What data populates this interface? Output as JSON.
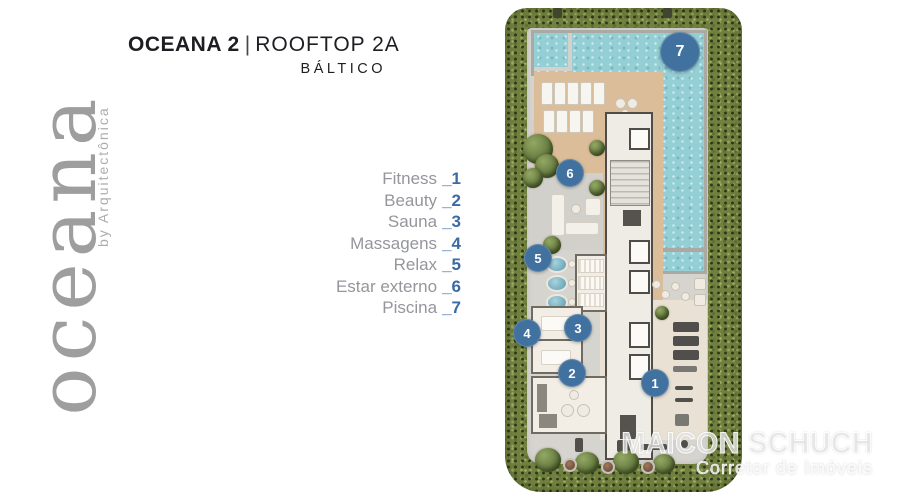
{
  "header": {
    "title_bold": "OCEANA 2",
    "title_divider": "|",
    "title_regular": "ROOFTOP 2A",
    "subtitle": "BÁLTICO"
  },
  "logo": {
    "wordmark": "oceana",
    "byline": "by Arquitectônica"
  },
  "legend": {
    "underscore": "_",
    "items": [
      {
        "label": "Fitness",
        "number": "1"
      },
      {
        "label": "Beauty",
        "number": "2"
      },
      {
        "label": "Sauna",
        "number": "3"
      },
      {
        "label": "Massagens",
        "number": "4"
      },
      {
        "label": "Relax",
        "number": "5"
      },
      {
        "label": "Estar externo",
        "number": "6"
      },
      {
        "label": "Piscina",
        "number": "7"
      }
    ]
  },
  "plan": {
    "markers": [
      "1",
      "2",
      "3",
      "4",
      "5",
      "6",
      "7"
    ]
  },
  "watermark": {
    "name": "MAICON SCHUCH",
    "role": "Corretor de Imóveis"
  },
  "colors": {
    "accent_blue": "#3a6ba5",
    "marker_blue": "#41719e",
    "pool_teal": "#93cfd4",
    "deck_tan": "#dcbd9a",
    "hedge_green": "#72803f",
    "floor_gray": "#d6d4cf",
    "label_gray": "#94969b",
    "title_dark": "#1d1d22"
  }
}
